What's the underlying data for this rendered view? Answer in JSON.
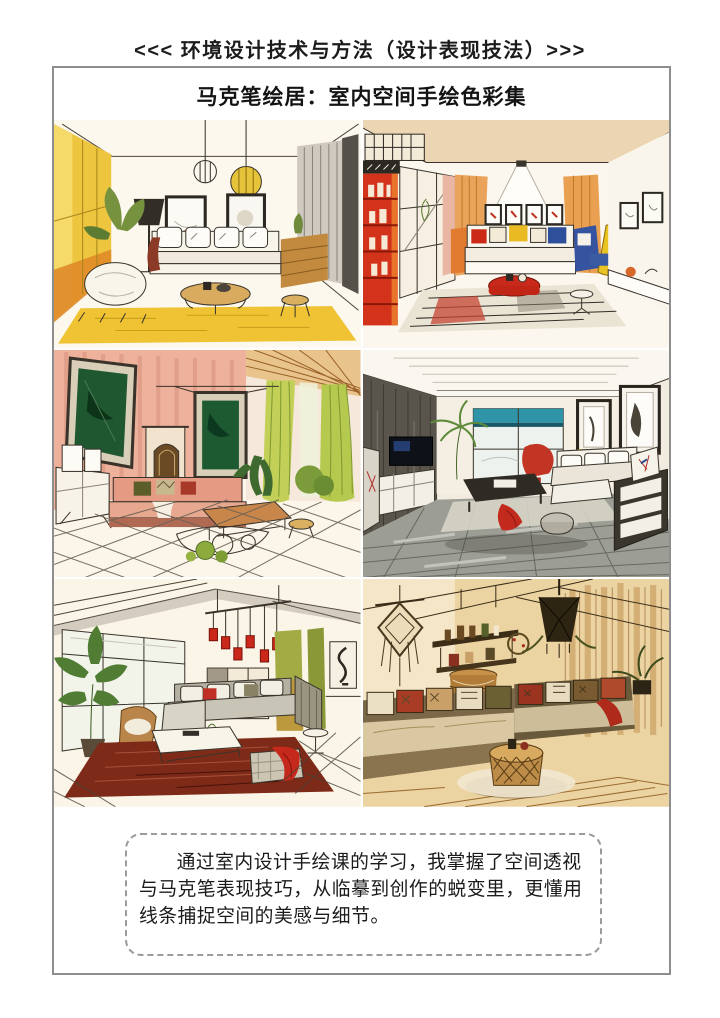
{
  "page": {
    "header": "<<< 环境设计技术与方法（设计表现技法）>>>",
    "title": "马克笔绘居：室内空间手绘色彩集",
    "caption": "通过室内设计手绘课的学习，我掌握了空间透视与马克笔表现技巧，从临摹到创作的蜕变里，更懂用线条捕捉空间的美感与细节。"
  },
  "gallery": {
    "items": [
      {
        "name": "marker-sketch-yellow-living-room"
      },
      {
        "name": "marker-sketch-red-bookshelf-living-room"
      },
      {
        "name": "marker-sketch-pink-wall-living-room"
      },
      {
        "name": "marker-sketch-gray-modern-living-room"
      },
      {
        "name": "marker-sketch-window-living-room-red-pendants"
      },
      {
        "name": "marker-sketch-boho-wood-living-room"
      }
    ]
  },
  "colors": {
    "page_text": "#1c1c1c",
    "frame_border": "#8e8e8e",
    "caption_border": "#9b9b9b",
    "sketch_yellow": "#edc53e",
    "sketch_red": "#d2301a",
    "sketch_pink": "#edb19c",
    "sketch_green": "#c2d058",
    "sketch_gray": "#59554c",
    "sketch_wood": "#c89a58"
  }
}
